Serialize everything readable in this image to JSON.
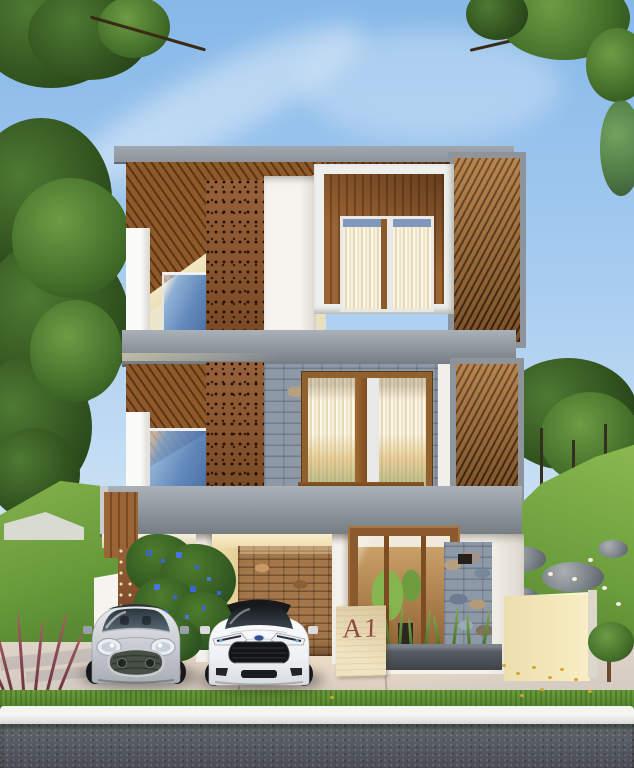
{
  "sign": {
    "label": "A1"
  },
  "colors": {
    "sky_top": "#86b8e8",
    "sky_mid": "#a9cdf0",
    "sky_low": "#cfe4f6",
    "roof_grey": "#8d949c",
    "wood": "#9a6434",
    "perf": "#87552e",
    "cream": "#e6d9ae",
    "stone_blue": "#8e99a7",
    "stone_warm": "#a3774a",
    "hill_light": "#86b34c",
    "hill_dark": "#3f6b26",
    "vine": "#4e7c2c",
    "sign_slab": "#f0e3c0",
    "sign_text": "#8b4a43",
    "planter": "#3f444a",
    "driveway": "#e0d4c8",
    "lawn": "#4f7f2a",
    "road": "#61666c",
    "leaf_gold": "#d6a437",
    "car_silver": "#c7cad0",
    "car_white": "#f4f5f7",
    "glass_blue": "#6f9ed4"
  }
}
